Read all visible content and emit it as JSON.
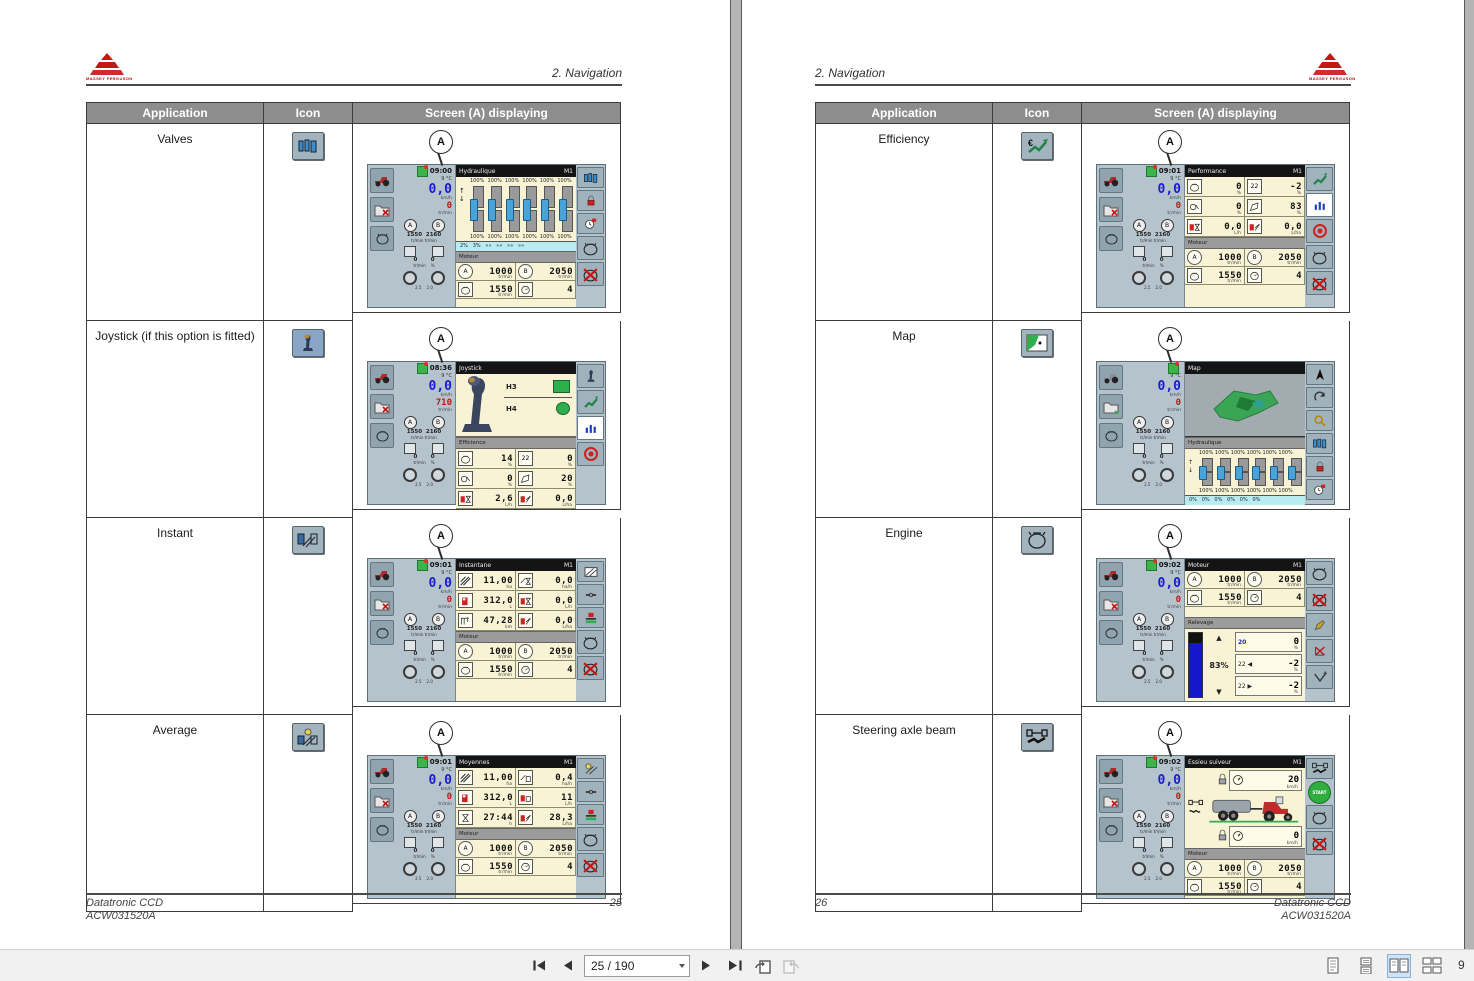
{
  "section_title": "2. Navigation",
  "logo_text": "MASSEY FERGUSON",
  "callout_label": "A",
  "table": {
    "application": "Application",
    "icon": "Icon",
    "screen": "Screen (A) displaying"
  },
  "page_left": {
    "rows": [
      "Valves",
      "Joystick (if this option is fitted)",
      "Instant",
      "Average"
    ]
  },
  "page_right": {
    "rows": [
      "Efficiency",
      "Map",
      "Engine",
      "Steering axle beam"
    ]
  },
  "footer": {
    "doc": "Datatronic CCD",
    "ref": "ACW031520A",
    "left_page": "25",
    "right_page": "26"
  },
  "toolbar": {
    "page_input": "25 / 190",
    "zoom_text": "9"
  },
  "common": {
    "speed": "0,0",
    "speed_unit": "km/h",
    "rpm_unit": "tr/min",
    "a_label": "A",
    "b_label": "B",
    "ab_vals": "1550  2160",
    "ab_units": "tr/min tr/min",
    "aux_vals": "0       0",
    "aux_units": "tr/min    %",
    "wheel_vals": "2.5    2.0",
    "temp": "9 °C"
  },
  "motor": {
    "title": "Moteur",
    "a": "1000",
    "au": "tr/min",
    "b": "2050",
    "bu": "tr/min",
    "e": "1550",
    "eu": "tr/min",
    "g": "4"
  },
  "screens": {
    "valves": {
      "time": "09:00",
      "rpm": "0",
      "title": "Hydraulique",
      "badge": "M1",
      "pct_top": "100%  100%  100%  100%  100%  100%",
      "pct_bot": "100%  100%  100%  100%  100%  100%",
      "strip": "2%   3%   »»   »»   »»   »»"
    },
    "joystick": {
      "time": "08:36",
      "rpm": "710",
      "title": "Joystick",
      "h3": "H3",
      "h4": "H4",
      "panel2": "Efficience",
      "c1": "14",
      "u1": "%",
      "c2": "0",
      "u2": "%",
      "c3": "0",
      "u3": "%",
      "c4": "20",
      "u4": "%",
      "c5": "2,6",
      "u5": "L/h",
      "c6": "0,0",
      "u6": "L/ha"
    },
    "instant": {
      "time": "09:01",
      "rpm": "0",
      "title": "Instantane",
      "badge": "M1",
      "c1": "11,00",
      "u1": "ha",
      "c2": "0,0",
      "u2": "ha/h",
      "c3": "312,0",
      "u3": "L",
      "c4": "0,0",
      "u4": "L/h",
      "c5": "47,28",
      "u5": "km",
      "c6": "0,0",
      "u6": "L/ha"
    },
    "average": {
      "time": "09:01",
      "rpm": "0",
      "title": "Moyennes",
      "badge": "M1",
      "c1": "11,00",
      "u1": "ha",
      "c2": "0,4",
      "u2": "ha/h",
      "c3": "312,0",
      "u3": "L",
      "c4": "11",
      "u4": "L/h",
      "c5": "27:44",
      "u5": "h",
      "c6": "28,3",
      "u6": "L/ha"
    },
    "efficiency": {
      "time": "09:01",
      "rpm": "0",
      "title": "Performance",
      "badge": "M1",
      "c1": "0",
      "u1": "%",
      "c2": "-2",
      "u2": "%",
      "c3": "0",
      "u3": "%",
      "c4": "83",
      "u4": "%",
      "c5": "0,0",
      "u5": "L/h",
      "c6": "0,0",
      "u6": "L/ha"
    },
    "map": {
      "time": "",
      "rpm": "0",
      "title": "Map",
      "panel2": "Hydraulique",
      "pct_top": "100% 100% 100% 100% 100% 100%",
      "pct_bot": "100% 100% 100% 100% 100% 100%",
      "strip": "0%   0%   0%   0%   0%   0%"
    },
    "engine": {
      "time": "09:02",
      "rpm": "0",
      "title": "Moteur",
      "badge": "M1",
      "panel2": "Relevage",
      "pct": "83%",
      "up": "▲",
      "down": "▼",
      "l1": "20",
      "c1": "0",
      "u1": "%",
      "l2": "22 ◀",
      "c2": "-2",
      "u2": "%",
      "l3": "22 ▶",
      "c3": "-2",
      "u3": "%"
    },
    "steering": {
      "time": "09:02",
      "rpm": "0",
      "title": "Essieu suiveur",
      "badge": "M1",
      "v_top": "20",
      "u_top": "km/h",
      "v_bot": "0",
      "u_bot": "km/h",
      "start": "START"
    }
  }
}
